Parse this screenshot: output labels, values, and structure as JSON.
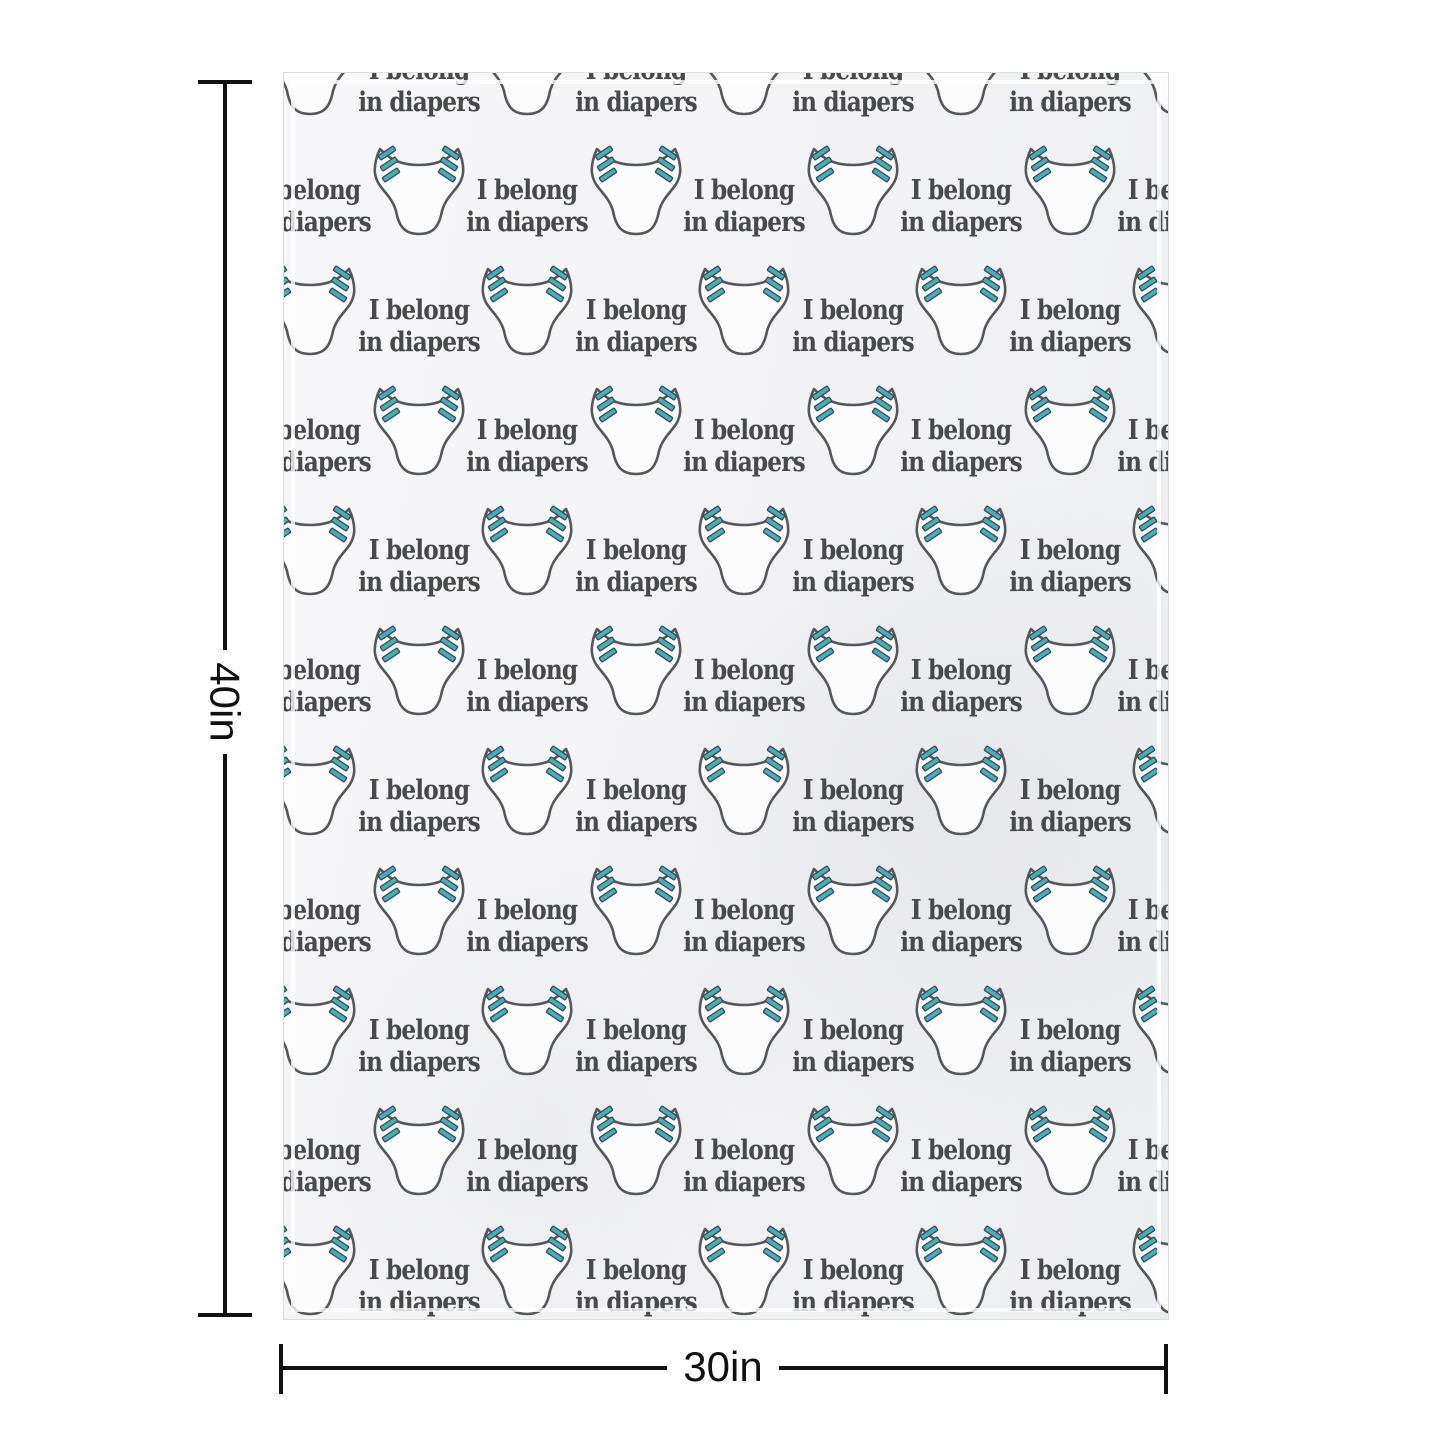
{
  "blanket": {
    "pattern": {
      "text_line1": "I belong",
      "text_line2": "in diapers"
    },
    "colors": {
      "fabric": "#f2f2f5",
      "diaper_fill": "#fcfcfd",
      "outline": "#54575b",
      "tab": "#45aebb",
      "tab_outline": "#3c4b4f",
      "text": "#48494c"
    },
    "grid": {
      "rows": 11,
      "cols": 9,
      "col_start": 26,
      "col_step": 108.5,
      "row_start": -5,
      "row_step": 120,
      "text_dy": 20
    }
  },
  "dimensions": {
    "height": {
      "label": "40in"
    },
    "width": {
      "label": "30in"
    },
    "line_color": "#101010"
  }
}
